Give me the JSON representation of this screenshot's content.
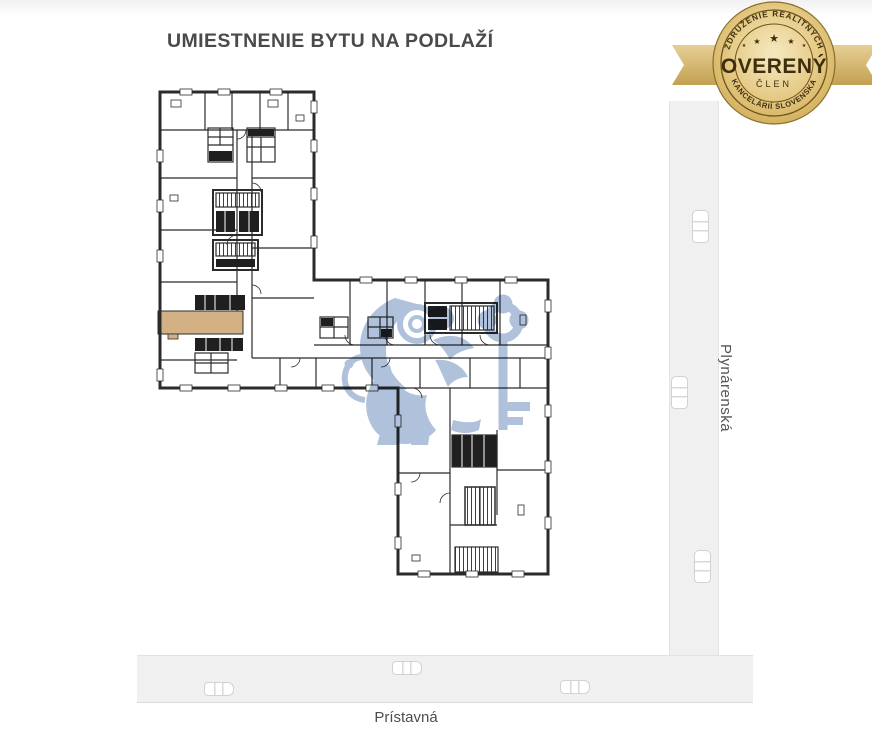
{
  "page": {
    "title": "UMIESTNENIE BYTU NA PODLAŽÍ"
  },
  "badge": {
    "arc_top": "ZDRUŽENIE REALITNÝCH",
    "title": "OVERENÝ",
    "subtitle": "ČLEN",
    "arc_bottom": "KANCELÁRIÍ SLOVENSKA",
    "star": "★"
  },
  "map": {
    "street_right": "Plynárenská",
    "street_bottom": "Prístavná"
  },
  "colors": {
    "highlight": "#d4b185",
    "watermark": "#a9bdd8",
    "road": "#f0f0f0",
    "wall": "#2b2b2b",
    "title-text": "#4a4a4a",
    "street-text": "#555555",
    "badge-text": "#3d2f0e"
  }
}
